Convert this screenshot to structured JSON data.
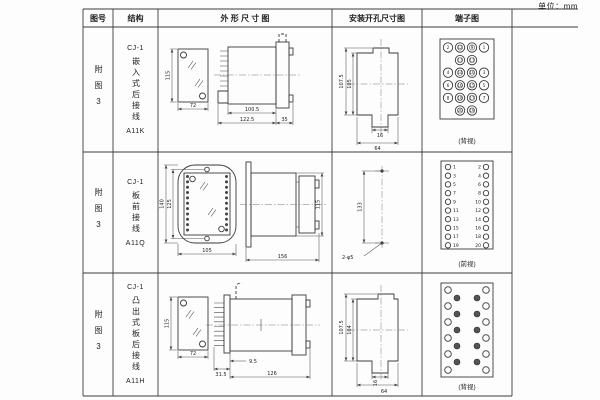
{
  "unit": "单位：mm",
  "table": {
    "headers": [
      "图号",
      "结构",
      "外 形 尺 寸 图",
      "安装开孔尺寸图",
      "端子图"
    ],
    "rows": [
      {
        "figure": "附图3",
        "series": "CJ-1",
        "structure": "嵌入式后接线",
        "model": "A11K",
        "outline": {
          "front_h": "115",
          "front_w": "72",
          "body_len": "100.5",
          "total_len": "122.5",
          "flange_w": "35"
        },
        "install": {
          "outer_h": "107.5",
          "inner_h": "105",
          "slot_w": "16",
          "total_w": "64"
        },
        "terminal": {
          "view": "(背视)",
          "type": "grid4",
          "items": [
            {
              "c": 0,
              "r": 0,
              "n": "2"
            },
            {
              "c": 1,
              "r": 0,
              "n": "12"
            },
            {
              "c": 2,
              "r": 0,
              "n": "9"
            },
            {
              "c": 3,
              "r": 0,
              "n": "1"
            },
            {
              "c": 1,
              "r": 1,
              "n": "13"
            },
            {
              "c": 2,
              "r": 1,
              "n": "11"
            },
            {
              "c": 0,
              "r": 2,
              "n": "4"
            },
            {
              "c": 1,
              "r": 2,
              "n": "14"
            },
            {
              "c": 2,
              "r": 2,
              "n": "10"
            },
            {
              "c": 3,
              "r": 2,
              "n": "3"
            },
            {
              "c": 0,
              "r": 3,
              "n": "6"
            },
            {
              "c": 1,
              "r": 3,
              "n": "16"
            },
            {
              "c": 2,
              "r": 3,
              "n": "15"
            },
            {
              "c": 3,
              "r": 3,
              "n": "5"
            },
            {
              "c": 0,
              "r": 4,
              "n": "8"
            },
            {
              "c": 1,
              "r": 4,
              "n": "18"
            },
            {
              "c": 2,
              "r": 4,
              "n": "17"
            },
            {
              "c": 3,
              "r": 4,
              "n": "7"
            },
            {
              "c": 1,
              "r": 5,
              "n": "20"
            },
            {
              "c": 2,
              "r": 5,
              "n": "19"
            }
          ]
        }
      },
      {
        "figure": "附图3",
        "series": "CJ-1",
        "structure": "板前接线",
        "model": "A11Q",
        "outline": {
          "front_h": "140",
          "hole_span": "125",
          "front_w": "105",
          "side_len": "156",
          "side_h": "115"
        },
        "install": {
          "spacing": "133",
          "holes": "2-φ5"
        },
        "terminal": {
          "view": "(前视)",
          "type": "pairs",
          "left": [
            "1",
            "3",
            "5",
            "7",
            "9",
            "11",
            "13",
            "15",
            "17",
            "19"
          ],
          "right": [
            "2",
            "4",
            "6",
            "8",
            "10",
            "12",
            "14",
            "16",
            "18",
            "20"
          ]
        }
      },
      {
        "figure": "附图3",
        "series": "CJ-1",
        "structure": "凸出式板后接线",
        "model": "A11H",
        "outline": {
          "front_h": "115",
          "front_w": "72",
          "fin_depth": "31.5",
          "gap": "9.5",
          "body_len": "126"
        },
        "install": {
          "outer_h": "107.5",
          "inner_h": "104",
          "slot_w": "16",
          "total_w": "64"
        },
        "terminal": {
          "view": "(背视)",
          "type": "stagger",
          "outer_rows": [
            0,
            2,
            4,
            6,
            8,
            10
          ],
          "inner_rows": [
            1,
            3,
            5,
            7,
            9
          ]
        }
      }
    ]
  }
}
